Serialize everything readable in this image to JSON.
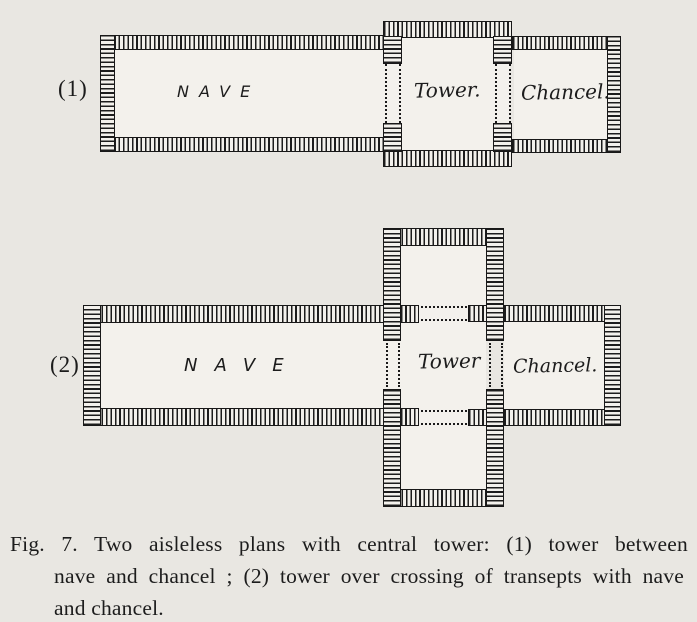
{
  "page": {
    "paper_color": "#e9e7e2",
    "ink_color": "#1c1c1c"
  },
  "figure": {
    "plan1": {
      "number": "(1)",
      "nave_label": "NAVE",
      "tower_label": "Tower.",
      "chancel_label": "Chancel."
    },
    "plan2": {
      "number": "(2)",
      "nave_label": "NAVE",
      "tower_label": "Tower",
      "chancel_label": "Chancel."
    },
    "caption": {
      "line1": "Fig. 7.  Two aisleless plans with central tower: (1) tower between",
      "line2": "nave and chancel ; (2) tower over crossing of transepts with nave",
      "line3": "and chancel."
    }
  }
}
